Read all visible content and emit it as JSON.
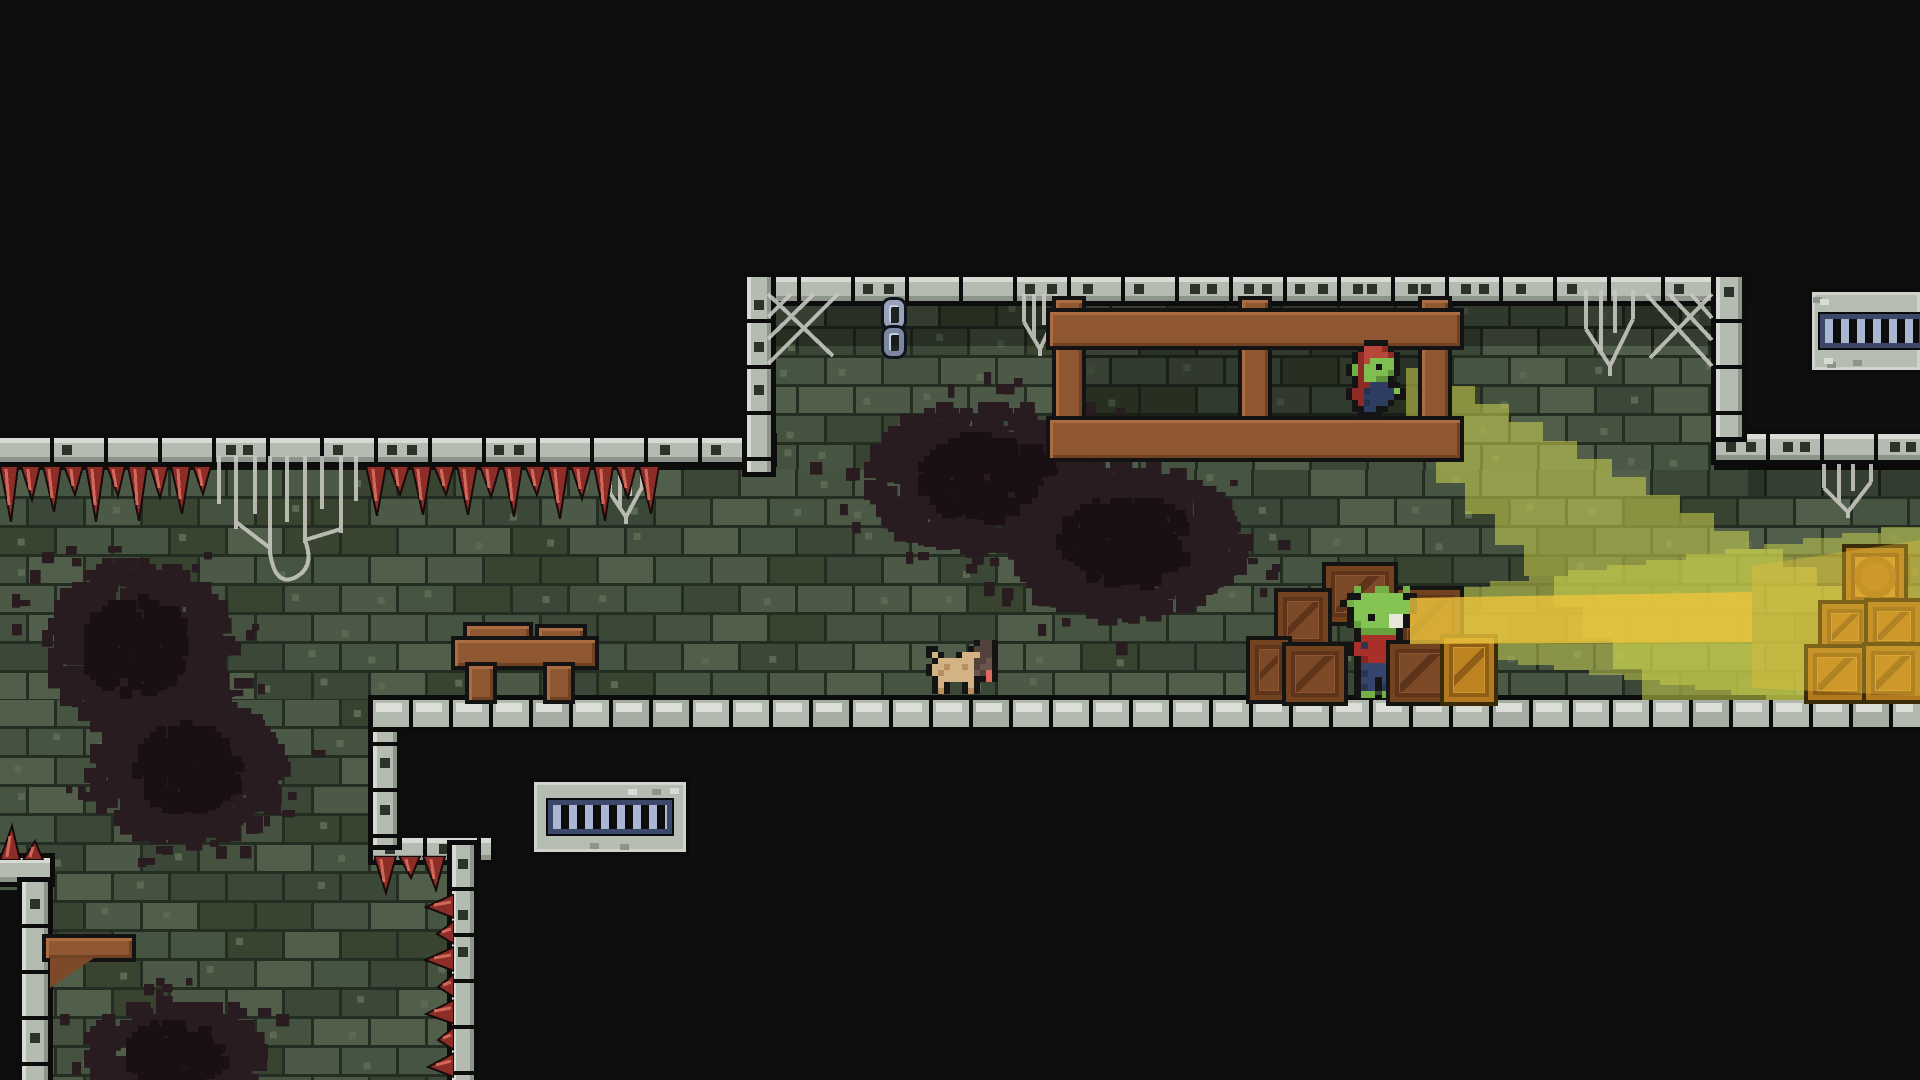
{
  "scene": {
    "title": "pixel-art dungeon platformer scene",
    "width": 1920,
    "height": 1080,
    "background": "#0e0e0e",
    "brick_base": "#45523f",
    "border_gray": "#b4bcb2",
    "floor_gray": "#b2bab0",
    "spike_red": "#8c2d27",
    "wood_brown": "#8f5732",
    "crate_brown": "#8f5530",
    "crate_lit_gold": "#d39731",
    "web_gray": "#c9c9c3",
    "chain_blue": "#98a2b8",
    "vent_slat_blue": "#a9b7d1",
    "beam_olive": "rgba(205,212,78,0.55)",
    "beam_gold": "rgba(236,196,60,0.8)"
  },
  "structure": {
    "brick_regions": [
      [
        770,
        300,
        944,
        176
      ],
      [
        0,
        470,
        1920,
        232
      ],
      [
        0,
        700,
        452,
        380
      ]
    ],
    "shadow_overlays": [
      [
        770,
        302,
        944,
        44,
        0.32
      ],
      [
        1086,
        346,
        332,
        76,
        0.3
      ],
      [
        1748,
        464,
        172,
        32,
        0.28
      ]
    ],
    "stains": [
      {
        "cx": 980,
        "cy": 470,
        "rx": 120,
        "ry": 72,
        "seed": 11
      },
      {
        "cx": 1120,
        "cy": 535,
        "rx": 115,
        "ry": 75,
        "seed": 12
      },
      {
        "cx": 130,
        "cy": 640,
        "rx": 90,
        "ry": 85,
        "seed": 13
      },
      {
        "cx": 180,
        "cy": 762,
        "rx": 95,
        "ry": 72,
        "seed": 14
      },
      {
        "cx": 168,
        "cy": 1048,
        "rx": 88,
        "ry": 52,
        "seed": 15
      }
    ],
    "black_masks": [
      [
        0,
        0,
        1920,
        279
      ],
      [
        0,
        279,
        749,
        161
      ],
      [
        1744,
        279,
        176,
        156
      ],
      [
        397,
        727,
        77,
        118
      ],
      [
        474,
        727,
        1446,
        353
      ],
      [
        0,
        890,
        24,
        190
      ]
    ],
    "borders_h": [
      [
        747,
        277,
        998,
        24
      ],
      [
        1716,
        434,
        204,
        26
      ],
      [
        0,
        438,
        772,
        24
      ],
      [
        373,
        838,
        118,
        22
      ],
      [
        0,
        858,
        50,
        24
      ]
    ],
    "borders_v": [
      [
        747,
        277,
        24,
        195
      ],
      [
        1716,
        277,
        26,
        160
      ],
      [
        373,
        700,
        24,
        145
      ],
      [
        452,
        845,
        22,
        235
      ],
      [
        22,
        882,
        26,
        198
      ]
    ],
    "floors": [
      [
        373,
        700,
        1547
      ]
    ]
  },
  "light_beams": {
    "diagonal": {
      "color": "rgba(205,212,78,0.55)",
      "from": [
        1406,
        368
      ],
      "top_end": [
        1920,
        640
      ],
      "bottom_start": [
        1406,
        452
      ],
      "bottom_end": [
        1642,
        700
      ],
      "corner": [
        1920,
        700
      ]
    },
    "horizontal": {
      "color": "rgba(205,212,78,0.5)",
      "from": [
        1412,
        592
      ],
      "top_end": [
        1920,
        522
      ],
      "bottom_start": [
        1412,
        650
      ],
      "bottom_end": [
        1766,
        700
      ],
      "corner": [
        1920,
        700
      ]
    },
    "core": {
      "color": "rgba(236,196,60,0.8)",
      "poly": [
        [
          1410,
          598
        ],
        [
          1752,
          592
        ],
        [
          1752,
          642
        ],
        [
          1410,
          644
        ]
      ]
    },
    "core_far": {
      "color": "rgba(228,188,54,0.38)",
      "poly": [
        [
          1752,
          566
        ],
        [
          1920,
          540
        ],
        [
          1920,
          696
        ],
        [
          1752,
          688
        ]
      ]
    }
  },
  "entities": [
    {
      "id": "cobweb-corner-left",
      "type": "web-corner",
      "x": 766,
      "y": 292,
      "w": 82,
      "h": 78,
      "flip": false,
      "i": false
    },
    {
      "id": "cobweb-strand-1",
      "type": "web-hang",
      "x": 1016,
      "y": 294,
      "w": 50,
      "h": 62,
      "i": false
    },
    {
      "id": "cobweb-strand-2",
      "type": "web-hang",
      "x": 1574,
      "y": 290,
      "w": 74,
      "h": 86,
      "i": false
    },
    {
      "id": "cobweb-corner-right",
      "type": "web-corner",
      "x": 1636,
      "y": 292,
      "w": 78,
      "h": 80,
      "flip": true,
      "i": false
    },
    {
      "id": "cobweb-ledge-right",
      "type": "web-hang",
      "x": 1812,
      "y": 464,
      "w": 74,
      "h": 54,
      "i": false
    },
    {
      "id": "cobweb-large-left",
      "type": "web-big",
      "x": 210,
      "y": 456,
      "w": 154,
      "h": 132,
      "i": false
    },
    {
      "id": "cobweb-strand-3",
      "type": "web-hang",
      "x": 602,
      "y": 468,
      "w": 50,
      "h": 56,
      "i": false
    },
    {
      "id": "hanging-chain",
      "type": "chain",
      "x": 884,
      "y": 300,
      "w": 24,
      "h": 62,
      "i": false
    },
    {
      "id": "ceiling-spikes-left",
      "type": "spikes",
      "x": 0,
      "y": 466,
      "w": 214,
      "h": 62,
      "dir": "down",
      "i": false
    },
    {
      "id": "ceiling-spikes-mid",
      "type": "spikes",
      "x": 366,
      "y": 466,
      "w": 296,
      "h": 62,
      "dir": "down",
      "i": false
    },
    {
      "id": "step-spikes",
      "type": "spikes",
      "x": 374,
      "y": 856,
      "w": 74,
      "h": 46,
      "dir": "down",
      "i": false
    },
    {
      "id": "wall-spikes",
      "type": "spikes",
      "x": 420,
      "y": 894,
      "w": 34,
      "h": 186,
      "dir": "left",
      "i": false
    },
    {
      "id": "ledge-spikes",
      "type": "spikes",
      "x": 0,
      "y": 818,
      "w": 46,
      "h": 42,
      "dir": "up",
      "i": false
    },
    {
      "id": "wooden-scaffold",
      "type": "scaffold",
      "x": 1050,
      "y": 296,
      "w": 410,
      "h": 164,
      "i": false
    },
    {
      "id": "goblin-lookout",
      "type": "goblin-hooded",
      "x": 1340,
      "y": 340,
      "w": 72,
      "h": 78,
      "i": true
    },
    {
      "id": "wooden-table",
      "type": "table",
      "x": 455,
      "y": 626,
      "w": 140,
      "h": 74,
      "i": true
    },
    {
      "id": "dog",
      "type": "dog",
      "x": 920,
      "y": 640,
      "w": 84,
      "h": 54,
      "i": true
    },
    {
      "id": "wall-vent-lower",
      "type": "vent",
      "x": 534,
      "y": 782,
      "w": 152,
      "h": 70,
      "i": true
    },
    {
      "id": "wall-vent-upper",
      "type": "vent",
      "x": 1812,
      "y": 292,
      "w": 108,
      "h": 78,
      "cut": true,
      "i": true
    },
    {
      "id": "wall-shelf",
      "type": "shelf",
      "x": 46,
      "y": 936,
      "w": 86,
      "h": 52,
      "i": true
    },
    {
      "id": "crate-top",
      "type": "crate",
      "x": 1326,
      "y": 566,
      "w": 68,
      "h": 56,
      "i": true
    },
    {
      "id": "crate-left-mid",
      "type": "crate",
      "x": 1278,
      "y": 592,
      "w": 50,
      "h": 56,
      "i": true
    },
    {
      "id": "crate-right-mid",
      "type": "crate",
      "x": 1398,
      "y": 590,
      "w": 62,
      "h": 60,
      "i": true
    },
    {
      "id": "goblin-lantern",
      "type": "goblin-lantern",
      "x": 1340,
      "y": 586,
      "w": 84,
      "h": 112,
      "i": true
    },
    {
      "id": "crate-left-low-1",
      "type": "crate",
      "x": 1250,
      "y": 640,
      "w": 38,
      "h": 60,
      "i": true
    },
    {
      "id": "crate-left-low-2",
      "type": "crate",
      "x": 1286,
      "y": 646,
      "w": 58,
      "h": 56,
      "i": true
    },
    {
      "id": "crate-right-low-1",
      "type": "crate",
      "x": 1390,
      "y": 644,
      "w": 60,
      "h": 58,
      "i": true
    },
    {
      "id": "crate-right-low-2",
      "type": "crate",
      "x": 1444,
      "y": 638,
      "w": 50,
      "h": 64,
      "lit": true,
      "i": true
    },
    {
      "id": "lit-barrel-crate",
      "type": "crate",
      "x": 1846,
      "y": 548,
      "w": 58,
      "h": 58,
      "lit": true,
      "barrel": true,
      "i": true
    },
    {
      "id": "lit-crate-1",
      "type": "crate",
      "x": 1822,
      "y": 604,
      "w": 46,
      "h": 46,
      "lit": true,
      "i": true
    },
    {
      "id": "lit-crate-2",
      "type": "crate",
      "x": 1868,
      "y": 602,
      "w": 52,
      "h": 48,
      "lit": true,
      "i": true
    },
    {
      "id": "lit-crate-3",
      "type": "crate",
      "x": 1808,
      "y": 648,
      "w": 58,
      "h": 52,
      "lit": true,
      "i": true
    },
    {
      "id": "lit-crate-4",
      "type": "crate",
      "x": 1866,
      "y": 646,
      "w": 54,
      "h": 54,
      "lit": true,
      "i": true
    }
  ]
}
